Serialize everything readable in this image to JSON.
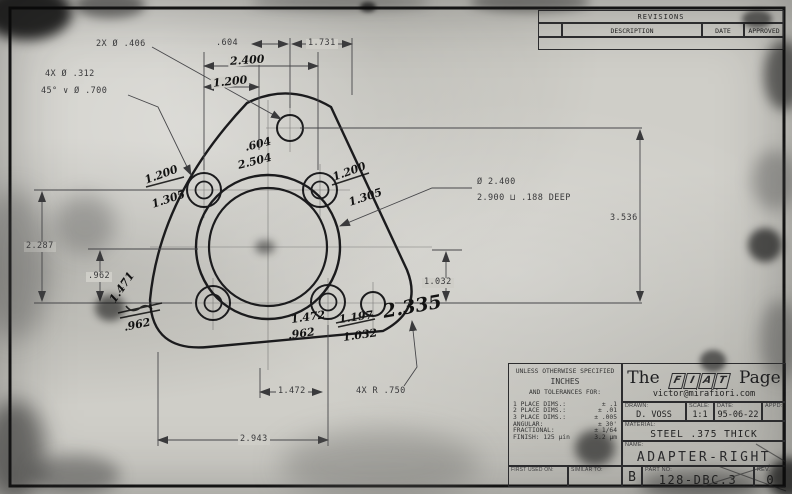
{
  "revisions": {
    "title": "REVISIONS",
    "col_sym": "",
    "col_description": "DESCRIPTION",
    "col_date": "DATE",
    "col_approved": "APPROVED"
  },
  "callouts": {
    "holes_2x": "2X Ø .406",
    "holes_4x": "4X Ø .312",
    "countersink": "45° ∨ Ø .700",
    "bore_dia": "Ø 2.400",
    "counterbore": "2.900 ⊔ .188 DEEP",
    "corner_radius": "4X R .750"
  },
  "dims": {
    "d604": ".604",
    "d1731": "1.731",
    "d2287": "2.287",
    "d962": ".962",
    "d3536": "3.536",
    "d1032": "1.032",
    "d1472": "1.472",
    "d2943": "2.943"
  },
  "handwritten": {
    "top_604": ".604",
    "top_2504": "2.504",
    "bc_2400": "2.400",
    "bc_1200": "1.200",
    "ul_1200": "1.200",
    "ul_1305": "1.305",
    "ur_1200": "1.200",
    "ur_1305": "1.305",
    "ll_1471": "1.471",
    "ll_962": ".962",
    "bl_1472": "1.472",
    "bl_962": ".962",
    "br_1197": "1.197",
    "br_1032": "1.032",
    "br_2335": "2.335"
  },
  "title_block": {
    "tolerances": {
      "line1": "UNLESS OTHERWISE SPECIFIED",
      "line2": "INCHES",
      "line3": "AND TOLERANCES FOR:",
      "rows": [
        [
          "1 PLACE DIMS.:",
          "± .1"
        ],
        [
          "2 PLACE DIMS.:",
          "± .01"
        ],
        [
          "3 PLACE DIMS.:",
          "± .005"
        ],
        [
          "ANGULAR:",
          "± 30'"
        ],
        [
          "FRACTIONAL:",
          "± 1/64"
        ],
        [
          "FINISH: 125 µin",
          "3.2 µm"
        ]
      ],
      "first_used": "FIRST USED ON:",
      "similar_to": "SIMILAR TO:"
    },
    "brand": {
      "the": "The",
      "fiat_f": "F",
      "fiat_i": "I",
      "fiat_a": "A",
      "fiat_t": "T",
      "page": "Page",
      "email": "victor@mirafiori.com"
    },
    "drawn_label": "DRAWN:",
    "drawn": "D. VOSS",
    "scale_label": "SCALE:",
    "scale": "1:1",
    "date_label": "DATE:",
    "date": "95-06-22",
    "appd_label": "APPD:",
    "appd": "",
    "material_label": "MATERIAL:",
    "material": "STEEL .375 THICK",
    "name_label": "NAME:",
    "name": "ADAPTER-RIGHT",
    "size": "B",
    "part_label": "PART NO:",
    "part_no": "128-DBC.3",
    "rev_label": "REV.",
    "rev": "0"
  }
}
